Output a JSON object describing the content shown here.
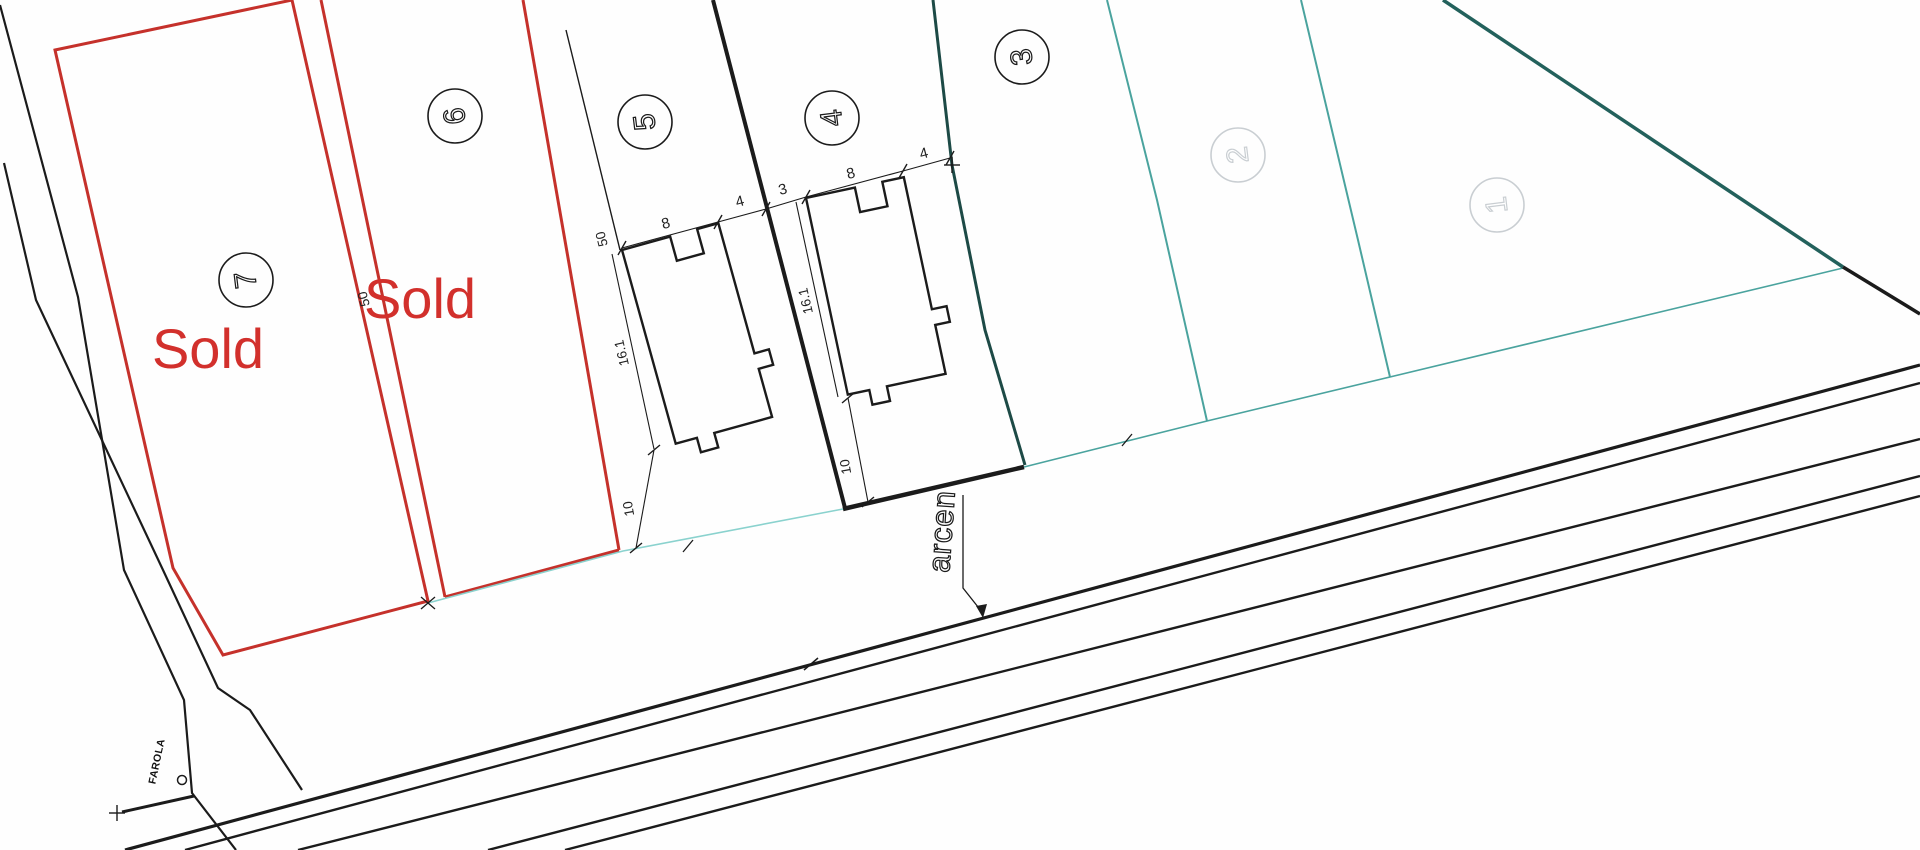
{
  "colors": {
    "red_boundary": "#c5312b",
    "sold_red": "#d2302c",
    "cyan_front_line": "#8ad2ce",
    "teal_mid_boundary": "#4aa39e",
    "teal_dark_diagonal": "#23615c",
    "teal_dark_lot43": "#1d4a46",
    "line_black": "#1b1b1b",
    "faded_gray": "#c9ced2"
  },
  "lots": [
    {
      "number": "7",
      "sold": "Sold"
    },
    {
      "number": "6",
      "sold": "Sold"
    },
    {
      "number": "5"
    },
    {
      "number": "4"
    },
    {
      "number": "3"
    },
    {
      "number": "2"
    },
    {
      "number": "1"
    }
  ],
  "dims": {
    "depth_a": "50",
    "depth_b": "50",
    "w5": "8",
    "s5": "4",
    "gap": "3",
    "w4": "8",
    "s4": "4",
    "d5": "16.1",
    "d4": "16.1",
    "set5": "10",
    "set4": "10"
  },
  "labels": {
    "shoulder": "arcen",
    "lamp": "FAROLA"
  }
}
